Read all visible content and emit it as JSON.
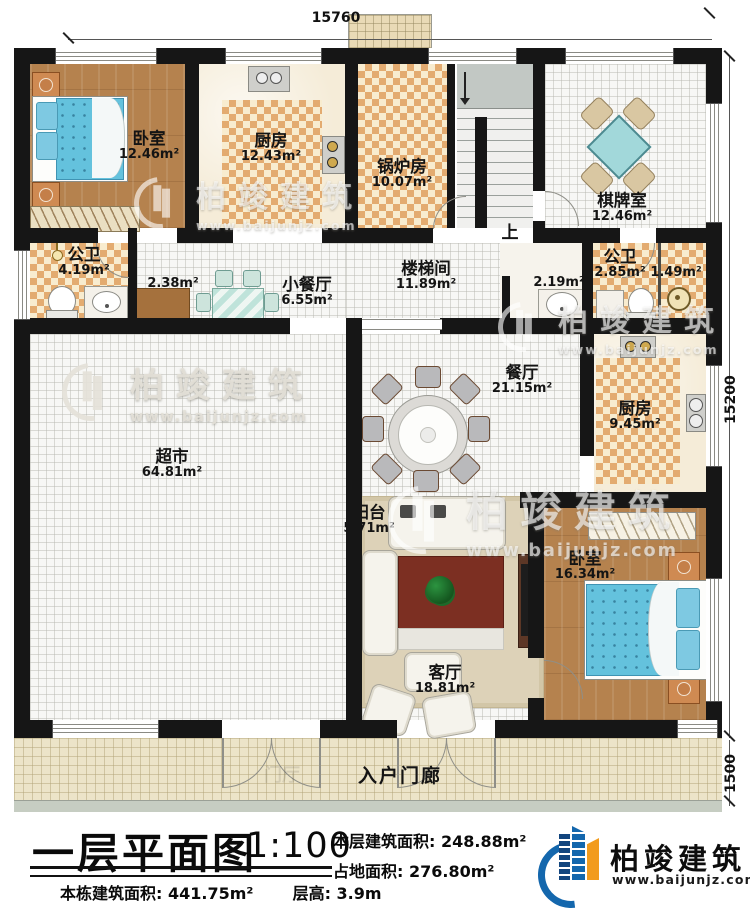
{
  "plan": {
    "dimensions": {
      "top": "15760",
      "side": "15200",
      "porch": "1500"
    },
    "stairs_up_label": "上",
    "rooms": {
      "bedroom1": {
        "name": "卧室",
        "area": "12.46m²"
      },
      "kitchen1": {
        "name": "厨房",
        "area": "12.43m²"
      },
      "boiler": {
        "name": "锅炉房",
        "area": "10.07m²"
      },
      "chess": {
        "name": "棋牌室",
        "area": "12.46m²"
      },
      "bath1": {
        "name": "公卫",
        "area": "4.19m²"
      },
      "closet1": {
        "area": "2.38m²"
      },
      "dining_small": {
        "name": "小餐厅",
        "area": "6.55m²"
      },
      "stair_hall": {
        "name": "楼梯间",
        "area": "11.89m²"
      },
      "vanity": {
        "area": "2.19m²"
      },
      "bath2": {
        "name": "公卫",
        "area": "2.85m²"
      },
      "closet2": {
        "area": "1.49m²"
      },
      "dining": {
        "name": "餐厅",
        "area": "21.15m²"
      },
      "kitchen2": {
        "name": "厨房",
        "area": "9.45m²"
      },
      "market": {
        "name": "超市",
        "area": "64.81m²"
      },
      "balcony": {
        "name": "阳台",
        "area": "5.71m²"
      },
      "living": {
        "name": "客厅",
        "area": "18.81m²"
      },
      "bedroom2": {
        "name": "卧室",
        "area": "16.34m²"
      },
      "porch": {
        "name": "入户门廊"
      },
      "foyer": {
        "name": "门厅"
      }
    }
  },
  "title_block": {
    "title": "一层平面图",
    "scale": "1:100",
    "floor_area_label": "本层建筑面积:",
    "floor_area_value": "248.88m²",
    "land_area_label": "占地面积:",
    "land_area_value": "276.80m²",
    "total_area_label": "本栋建筑面积:",
    "total_area_value": "441.75m²",
    "story_height_label": "层高:",
    "story_height_value": "3.9m"
  },
  "brand": {
    "name": "柏竣建筑",
    "url": "www.baijunjz.com"
  },
  "colors": {
    "wall": "#161616",
    "logo_blue": "#1467ad",
    "logo_orange": "#f29b1d",
    "bed_blue": "#64c2dd",
    "checker_tan": "#e3ab70"
  }
}
